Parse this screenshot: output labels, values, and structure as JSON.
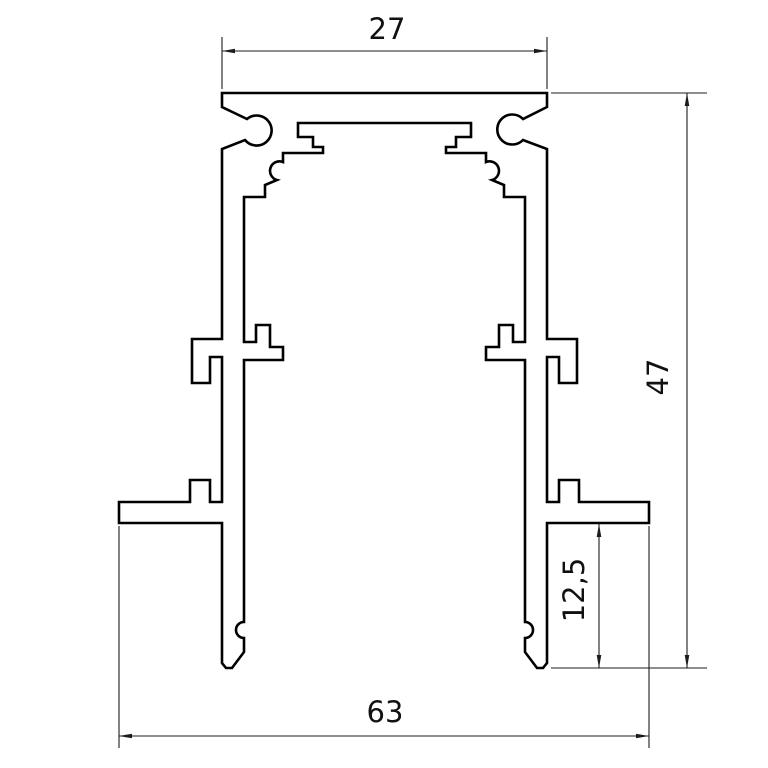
{
  "drawing": {
    "type": "profile-cross-section",
    "background_color": "#ffffff",
    "outline_color": "#000000",
    "dimension_line_color": "#1c1c1c",
    "text_color": "#111111",
    "dimensions": {
      "top_width": "27",
      "overall_height": "47",
      "foot_height": "12,5",
      "bottom_width": "63"
    }
  }
}
